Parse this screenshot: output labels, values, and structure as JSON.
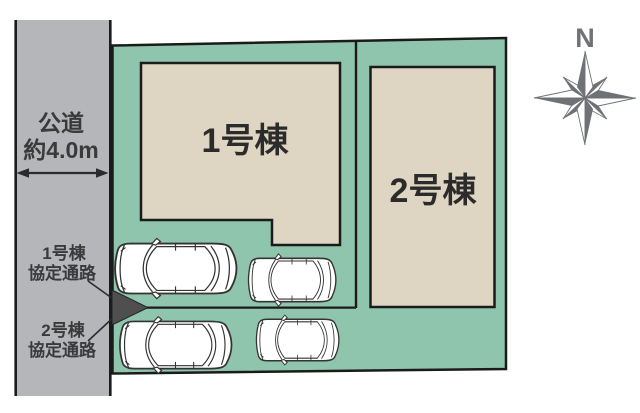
{
  "colors": {
    "background": "#ffffff",
    "site_green": "#8fc4ad",
    "building_beige": "#ded6c2",
    "road_gray": "#b4b6b9",
    "outline_black": "#1b1b1b",
    "text_dark": "#3a3a3a",
    "label_black": "#2b2b2b",
    "compass_gray": "#6e7276",
    "arrow_dark": "#4f4f4f"
  },
  "road": {
    "name_line1": "公道",
    "name_line2": "約4.0m"
  },
  "buildings": [
    {
      "label": "1号棟"
    },
    {
      "label": "2号棟"
    }
  ],
  "passage_labels": [
    {
      "line1": "1号棟",
      "line2": "協定通路"
    },
    {
      "line1": "2号棟",
      "line2": "協定通路"
    }
  ],
  "compass": {
    "label": "N"
  },
  "icons": [
    "car-top-view-icon",
    "car-top-view-icon",
    "car-top-view-icon",
    "car-top-view-icon",
    "compass-rose-icon",
    "passage-arrow-icon",
    "road-width-arrow-icon"
  ]
}
